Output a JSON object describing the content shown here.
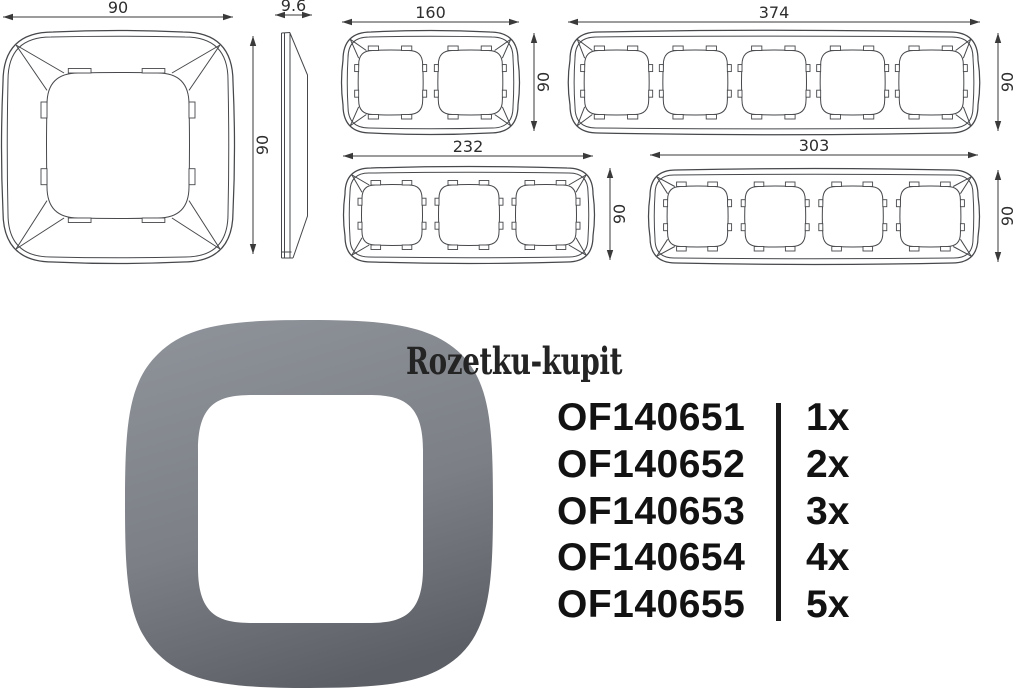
{
  "watermark": {
    "text": "Rozetku-kupit"
  },
  "technical_drawings": {
    "front_view": {
      "width_label": "90",
      "height_label": "90",
      "windows": 1
    },
    "side_view": {
      "thickness_label": "9.6"
    },
    "two_gang": {
      "width_label": "160",
      "height_label": "90",
      "windows": 2
    },
    "five_gang": {
      "width_label": "374",
      "height_label": "90",
      "windows": 5
    },
    "three_gang": {
      "width_label": "232",
      "height_label": "90",
      "windows": 3
    },
    "four_gang": {
      "width_label": "303",
      "height_label": "90",
      "windows": 4
    }
  },
  "products": [
    {
      "code": "OF140651",
      "qty": "1x"
    },
    {
      "code": "OF140652",
      "qty": "2x"
    },
    {
      "code": "OF140653",
      "qty": "3x"
    },
    {
      "code": "OF140654",
      "qty": "4x"
    },
    {
      "code": "OF140655",
      "qty": "5x"
    }
  ],
  "colors": {
    "background": "#ffffff",
    "drawing_line": "#46484b",
    "dim_text": "#2e2e2e",
    "list_text": "#121212",
    "divider": "#1a1a1a",
    "frame_top": "#8d9198",
    "frame_mid": "#7c8086",
    "frame_bottom": "#5c5f66"
  }
}
